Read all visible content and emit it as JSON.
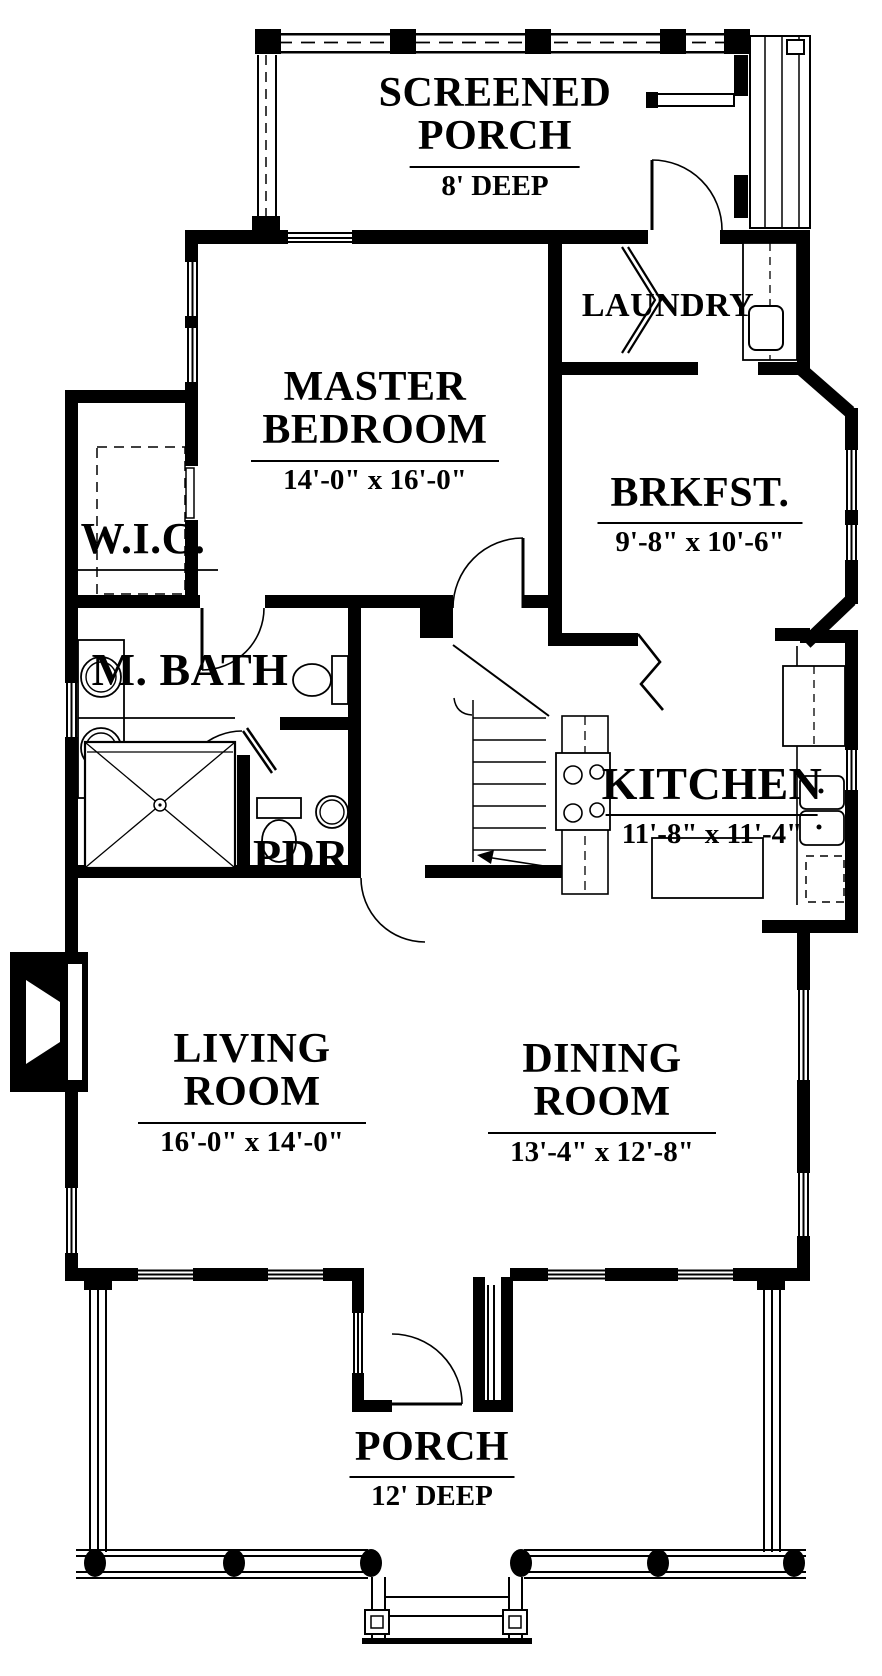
{
  "drawing": {
    "kind": "first-floor house plan",
    "ink_color": "#000000",
    "paper_color": "#ffffff"
  },
  "rooms": [
    {
      "id": "screened-porch",
      "name_lines": [
        "SCREENED",
        "PORCH"
      ],
      "dims": "8' DEEP"
    },
    {
      "id": "master-bedroom",
      "name_lines": [
        "MASTER",
        "BEDROOM"
      ],
      "dims": "14'-0\" x 16'-0\""
    },
    {
      "id": "laundry",
      "name_lines": [
        "LAUNDRY"
      ],
      "dims": ""
    },
    {
      "id": "breakfast",
      "name_lines": [
        "BRKFST."
      ],
      "dims": "9'-8\" x 10'-6\""
    },
    {
      "id": "walk-in-closet",
      "name_lines": [
        "W.I.C."
      ],
      "dims": ""
    },
    {
      "id": "master-bath",
      "name_lines": [
        "M. BATH"
      ],
      "dims": ""
    },
    {
      "id": "powder-room",
      "name_lines": [
        "PDR."
      ],
      "dims": ""
    },
    {
      "id": "kitchen",
      "name_lines": [
        "KITCHEN"
      ],
      "dims": "11'-8\" x 11'-4\""
    },
    {
      "id": "living-room",
      "name_lines": [
        "LIVING",
        "ROOM"
      ],
      "dims": "16'-0\" x 14'-0\""
    },
    {
      "id": "dining-room",
      "name_lines": [
        "DINING",
        "ROOM"
      ],
      "dims": "13'-4\" x 12'-8\""
    },
    {
      "id": "front-porch",
      "name_lines": [
        "PORCH"
      ],
      "dims": "12' DEEP"
    }
  ],
  "fixtures": [
    "washer-dryer-icon",
    "bifold-door-icon",
    "range-icon",
    "refrigerator-icon",
    "kitchen-sink-icon",
    "double-vanity-icon",
    "toilet-icon",
    "shower-icon",
    "pedestal-sink-icon",
    "fireplace-icon",
    "staircase-icon",
    "porch-column-icon",
    "porch-steps-icon",
    "door-swing-icon",
    "window-icon",
    "closet-shelf-icon"
  ]
}
